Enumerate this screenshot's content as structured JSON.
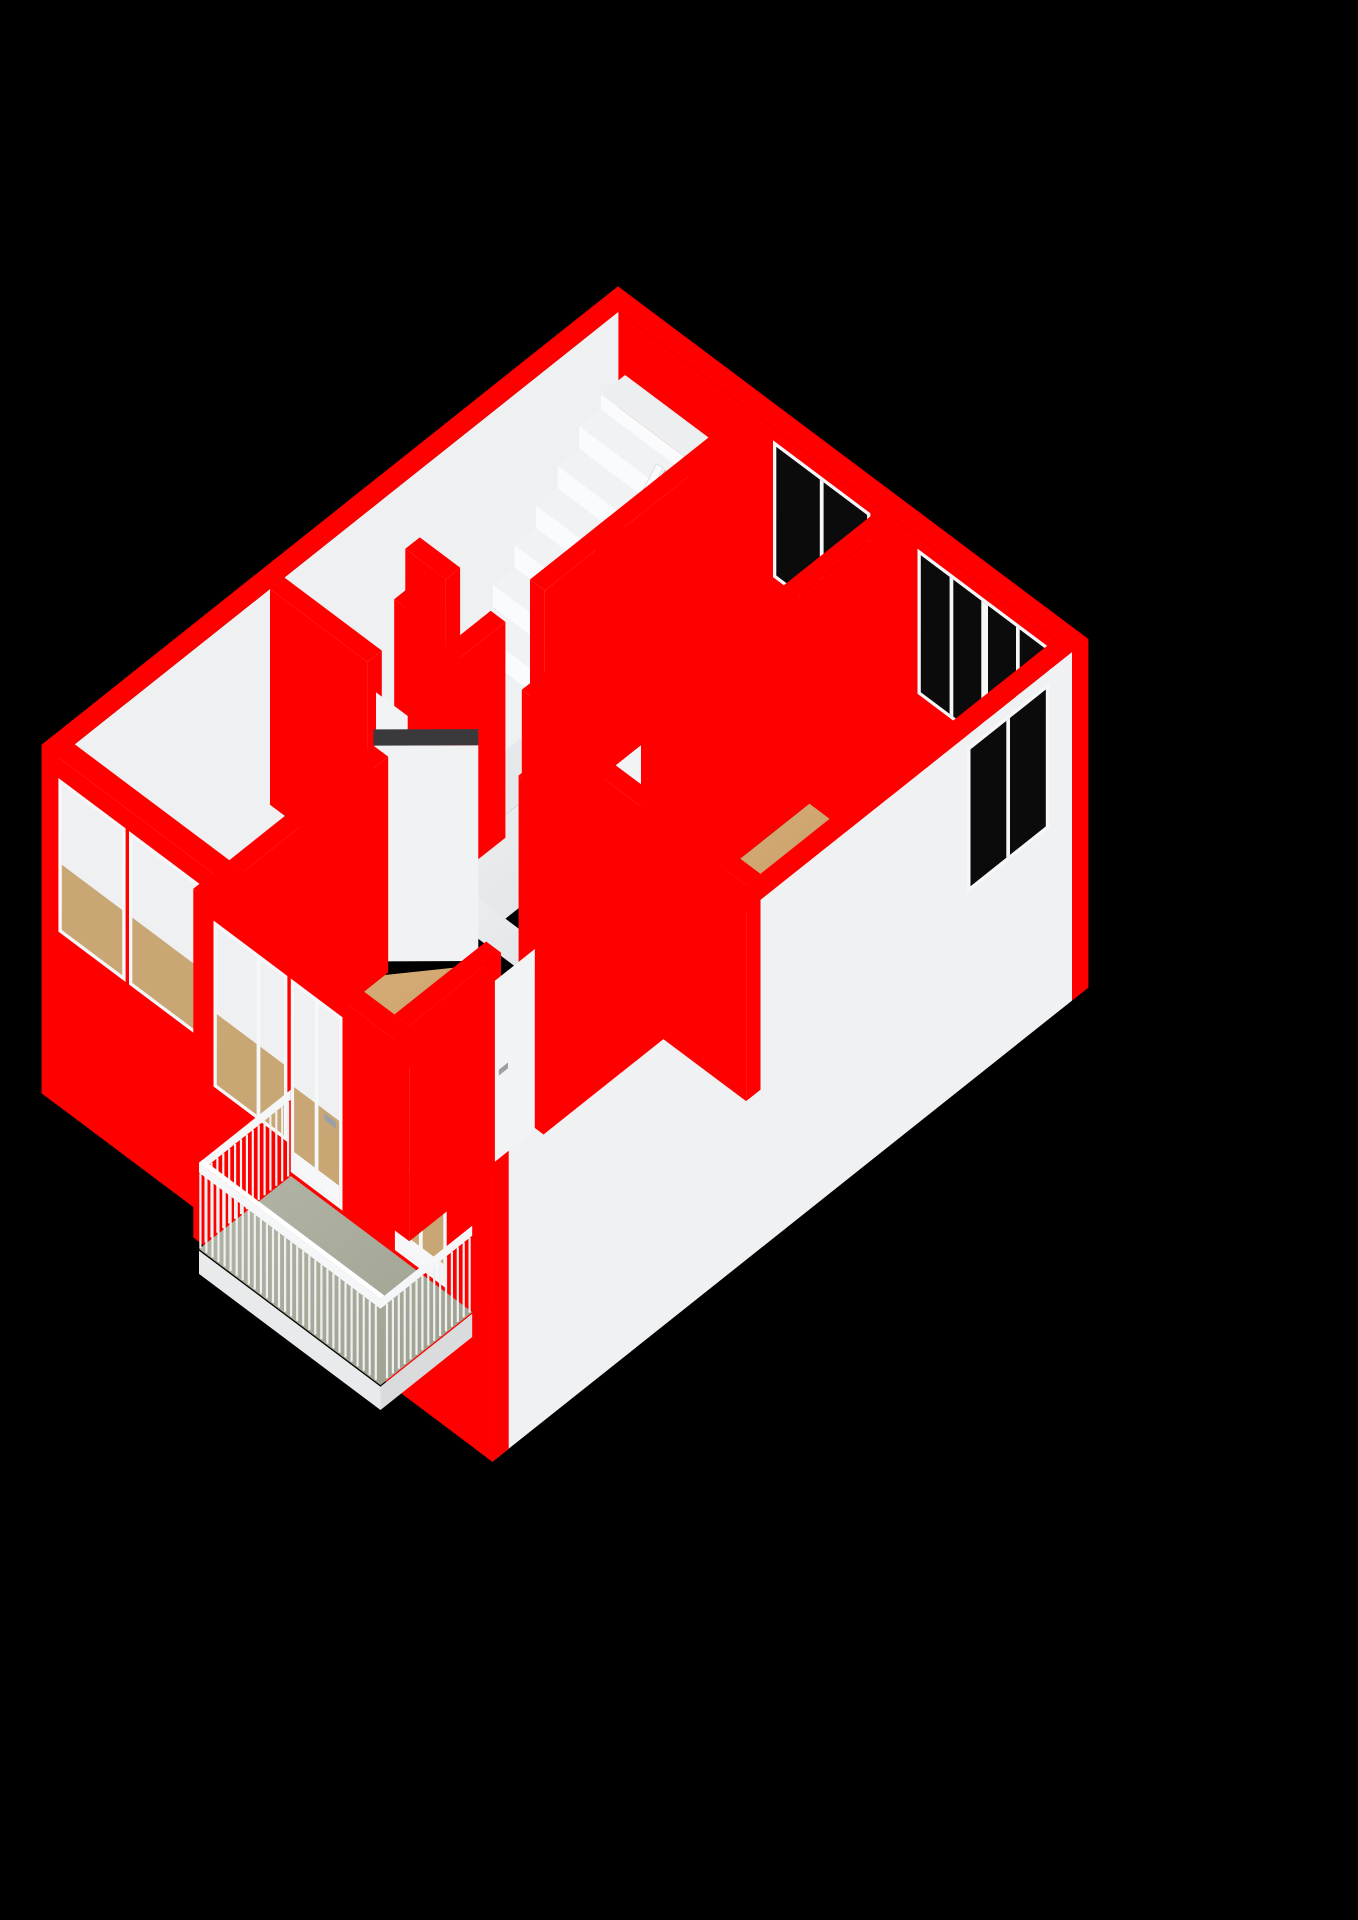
{
  "meta": {
    "title": "3D floor plan — upper storey cutaway",
    "background": "#000000",
    "view": "axonometric-3d"
  },
  "colors": {
    "wall_top": "#3a3a3c",
    "face_s": "#f3f4f6",
    "face_s_ext": "#fbfcfd",
    "face_e": "#c7cbce",
    "face_e_ext": "#eff1f3",
    "face_w_int": "#eef0f2",
    "floor_tan_1": "#d8b07a",
    "floor_tan_2": "#c2955e",
    "floor_bath_1": "#c8d4de",
    "floor_bath_2": "#adbbc8",
    "floor_hall": "#eaecee",
    "floor_closet": "#e2e4e6",
    "floor_kitchen": "#e7e9eb",
    "floor_balcony_1": "#b3b6a7",
    "floor_balcony_2": "#9da08f",
    "glass_dark": "#0b0b0c",
    "glass_int_low": "#c9a775",
    "glass_int_high": "#eef0f1",
    "frame": "#f6f7f8",
    "leaf": "#f2f3f5",
    "handle": "#9aa0a5",
    "stair_top": "#f1f2f4",
    "stair_riser": "#fafbfd",
    "stair_side": "#d3d6d9",
    "enclosure_top": "#eceef0",
    "arrow": "#fafbfc",
    "arrow_shadow": "#c4c7ca",
    "rail": "#eef0f1",
    "rail_band": "#f5f6f8",
    "slab_edge": "#e8eaec",
    "slab_edge_dark": "#d9dbdd",
    "chamfer_face": "#f0f2f4"
  },
  "scene": {
    "wall_height": 2.6,
    "rooms": [
      {
        "name": "landing-floor",
        "fill": "hall",
        "rect": [
          0.25,
          0.25,
          2.15,
          5.35
        ]
      },
      {
        "name": "hall-floor",
        "fill": "hall",
        "rect": [
          2.15,
          2.55,
          3.15,
          5.35
        ]
      },
      {
        "name": "hall-floor-south",
        "fill": "hall",
        "rect": [
          2.15,
          4.95,
          4.37,
          5.35
        ]
      },
      {
        "name": "bathroom-floor",
        "fill": "bath",
        "rect": [
          2.37,
          0.25,
          4.15,
          2.33
        ]
      },
      {
        "name": "closet-1-floor",
        "fill": "closet",
        "rect": [
          3.35,
          2.55,
          4.15,
          3.5
        ]
      },
      {
        "name": "closet-2-floor",
        "fill": "closet",
        "rect": [
          3.35,
          3.7,
          4.15,
          4.5
        ]
      },
      {
        "name": "bedroom-right-floor",
        "fill": "tan",
        "rect": [
          4.37,
          0.25,
          6.75,
          4.75
        ]
      },
      {
        "name": "bedroom-west-floor",
        "fill": "tan",
        "rect": [
          0.25,
          5.57,
          2.55,
          8.55
        ]
      },
      {
        "name": "living-room-floor",
        "fill": "tan",
        "poly": [
          [
            2.77,
            6.4
          ],
          [
            3.42,
            5.57
          ],
          [
            4.37,
            5.57
          ],
          [
            4.37,
            4.97
          ],
          [
            5.3,
            4.97
          ],
          [
            5.3,
            8.85
          ],
          [
            2.77,
            8.85
          ]
        ]
      },
      {
        "name": "kitchen-floor",
        "fill": "kitchen",
        "rect": [
          5.52,
          4.97,
          6.75,
          8.85
        ]
      }
    ],
    "objects": [
      {
        "type": "wall",
        "n": "wall-north-exterior",
        "r": [
          0,
          0,
          7.0,
          0.25
        ],
        "ext": 1,
        "win": [
          {
            "a": 2.6,
            "b": 3.95,
            "s": 0.85,
            "t": 2.4,
            "glass": "dark",
            "mull": [
              0.5
            ]
          },
          {
            "a": 4.75,
            "b": 6.65,
            "s": 0.75,
            "t": 2.4,
            "glass": "dark",
            "mull": [
              0.24,
              0.5,
              0.76
            ],
            "thick": 1
          }
        ]
      },
      {
        "type": "wall",
        "n": "wall-west-exterior",
        "r": [
          0,
          0.25,
          0.25,
          8.8
        ],
        "ext": 1,
        "fE": "face_w_int"
      },
      {
        "type": "wall",
        "n": "stairwell-enclosure",
        "r": [
          0.35,
          0.25,
          1.65,
          0.62
        ],
        "h": 1.9,
        "top": "enclosure_top",
        "fS": "stair_riser"
      },
      {
        "type": "stairs",
        "n": "staircase",
        "x1": 0.35,
        "x2": 1.65,
        "v0": 0.62,
        "dv": 0.33,
        "steps": 6,
        "ztop": 1.72,
        "dz": 0.27
      },
      {
        "type": "arrow",
        "n": "stairs-down-arrow",
        "u": 1.45,
        "from": [
          0.85,
          1.85
        ],
        "to": [
          2.42,
          0.42
        ],
        "halfw": 0.075,
        "head_half": 0.2,
        "head_len": 0.45
      },
      {
        "type": "wall",
        "n": "wall-bathroom-west",
        "r": [
          2.15,
          0.25,
          2.37,
          3.55
        ]
      },
      {
        "type": "wall",
        "n": "wall-bedroom-right-west-a",
        "r": [
          4.15,
          0.25,
          4.37,
          4.0
        ]
      },
      {
        "type": "wall",
        "n": "wall-bathroom-south",
        "r": [
          2.15,
          2.33,
          4.35,
          2.55
        ]
      },
      {
        "type": "wall",
        "n": "wall-hall-divider-a",
        "r": [
          0.9,
          3.95,
          1.5,
          4.17
        ]
      },
      {
        "type": "wall",
        "n": "wall-hall-divider-b",
        "r": [
          1.3,
          4.17,
          1.5,
          4.75
        ]
      },
      {
        "type": "wall",
        "n": "wall-hall-south-a",
        "r": [
          0.25,
          5.35,
          1.7,
          5.57
        ],
        "leafS": {
          "a": 1.7,
          "b": 2.3,
          "handle": 2.24
        }
      },
      {
        "type": "wall",
        "n": "wall-closet-west",
        "r": [
          3.15,
          2.55,
          3.35,
          4.5
        ]
      },
      {
        "type": "wall",
        "n": "wall-corridor-stub",
        "r": [
          2.15,
          4.15,
          2.37,
          4.95
        ]
      },
      {
        "type": "wall",
        "n": "wall-closet-mid",
        "r": [
          3.15,
          3.5,
          4.15,
          3.7
        ]
      },
      {
        "type": "wall",
        "n": "wall-east-exterior",
        "r": [
          6.75,
          0.25,
          7.0,
          9.1
        ],
        "ext": 1,
        "fE": "face_e_ext",
        "winE": [
          {
            "a": 0.65,
            "b": 1.8,
            "s": 0.75,
            "t": 2.4,
            "glass": "dark",
            "mull": [
              0.5
            ]
          }
        ]
      },
      {
        "type": "wall",
        "n": "wall-closet-south",
        "r": [
          3.15,
          4.5,
          4.15,
          4.7
        ]
      },
      {
        "type": "wall",
        "n": "wall-hall-south-b",
        "r": [
          2.3,
          5.35,
          2.55,
          5.57
        ]
      },
      {
        "type": "chamfer",
        "n": "wall-living-chamfer",
        "a": [
          2.55,
          6.35
        ],
        "b": [
          3.35,
          5.57
        ]
      },
      {
        "type": "wall",
        "n": "wall-front-bedroom-west",
        "r": [
          0,
          8.55,
          2.8,
          8.8
        ],
        "ext": 1,
        "win": [
          {
            "a": 0.3,
            "b": 1.2,
            "s": 0.55,
            "t": 2.3,
            "glass": "int"
          },
          {
            "a": 1.35,
            "b": 2.35,
            "s": 0.55,
            "t": 2.3,
            "glass": "int"
          }
        ]
      },
      {
        "type": "wall",
        "n": "wall-bedroom-right-west-b",
        "r": [
          4.15,
          4.6,
          4.37,
          4.95
        ],
        "leafE": {
          "a": 4.0,
          "b": 4.6,
          "handle": 4.52
        }
      },
      {
        "type": "wall",
        "n": "wall-bedroom-west-east",
        "r": [
          2.55,
          6.35,
          2.77,
          8.55
        ]
      },
      {
        "type": "wall",
        "n": "wall-bedroom-right-south",
        "r": [
          4.37,
          4.75,
          6.75,
          4.97
        ]
      },
      {
        "type": "wall",
        "n": "wall-hall-south-c",
        "r": [
          3.95,
          5.35,
          4.37,
          5.57
        ]
      },
      {
        "type": "wall",
        "n": "wall-kitchen-west-a",
        "r": [
          5.3,
          4.97,
          5.52,
          6.8
        ]
      },
      {
        "type": "wall",
        "n": "wall-front-jog",
        "r": [
          2.55,
          8.55,
          2.8,
          9.1
        ],
        "ext": 1
      },
      {
        "type": "wall",
        "n": "wall-front-main",
        "r": [
          2.6,
          8.85,
          7.0,
          9.1
        ],
        "ext": 1,
        "win": [
          {
            "a": 2.9,
            "b": 3.9,
            "s": 0.45,
            "t": 2.35,
            "glass": "int",
            "mull": [
              0.62
            ]
          },
          {
            "a": 4.05,
            "b": 4.72,
            "s": 0.12,
            "t": 2.35,
            "glass": "int",
            "mull": [
              0.5
            ],
            "door": 1,
            "handle": 4.62
          },
          {
            "a": 5.6,
            "b": 6.27,
            "s": 0.12,
            "t": 2.35,
            "glass": "int",
            "mull": [
              0.5
            ],
            "door": 1,
            "handle": 6.17
          }
        ]
      },
      {
        "type": "wall",
        "n": "wall-kitchen-west-b",
        "r": [
          5.3,
          7.45,
          5.52,
          8.85
        ],
        "leafE": {
          "a": 6.8,
          "b": 7.45,
          "handle": 7.37
        }
      },
      {
        "type": "balcony",
        "n": "balcony",
        "r": [
          4.0,
          9.1,
          6.7,
          10.5
        ],
        "rail_h": 1.06,
        "post_step": 0.09
      }
    ]
  }
}
